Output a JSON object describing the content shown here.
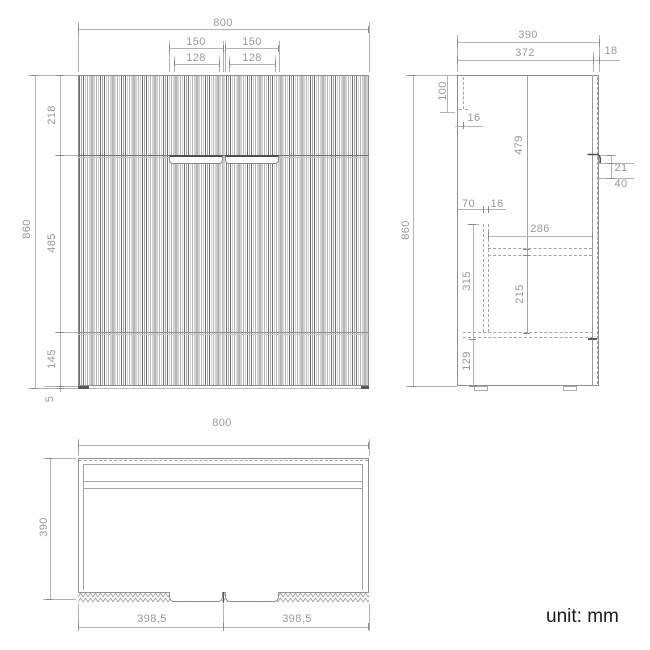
{
  "palette": {
    "line_color": "#9a9a9a",
    "dark_color": "#555555",
    "text_color": "#1a1a1a"
  },
  "unit_note": "unit: mm",
  "front_view": {
    "width": "800",
    "handle_width_left": "150",
    "handle_width_right": "150",
    "handle_cutout_left": "128",
    "handle_cutout_right": "128",
    "height": "860",
    "top_section": "218",
    "door_section": "485",
    "lower_section": "145",
    "bottom_edge": "5"
  },
  "side_view": {
    "depth": "390",
    "carcass_depth": "372",
    "front_panel_thickness": "18",
    "top_back_gap": "100",
    "back_panel_thickness": "16",
    "upper_cavity_height": "479",
    "handle_recess_height": "21",
    "handle_zone_height": "40",
    "rail_offset": "70",
    "rail_thickness": "16",
    "shelf_depth": "286",
    "lower_cavity_height": "315",
    "under_shelf_height": "215",
    "plinth_height": "129",
    "height": "860"
  },
  "plan_view": {
    "width": "800",
    "depth": "390",
    "left_door_width": "398,5",
    "right_door_width": "398,5"
  }
}
